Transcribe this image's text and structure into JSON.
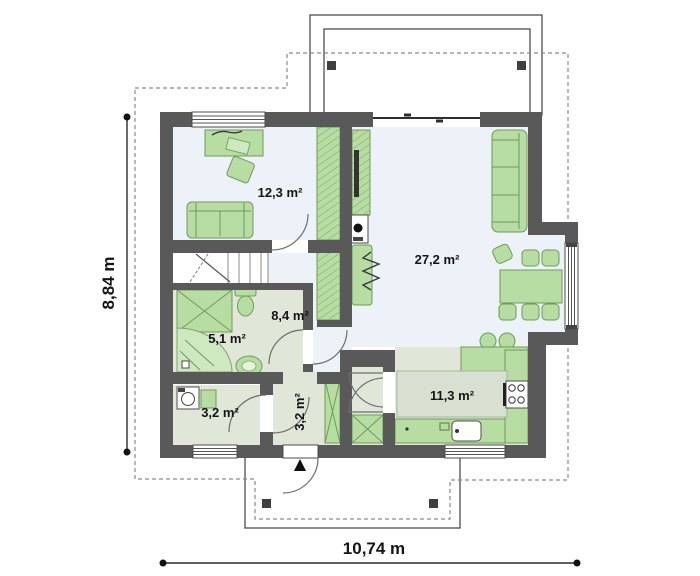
{
  "plan": {
    "type": "architectural-floor-plan",
    "rooms": [
      {
        "key": "bedroom",
        "area": "12,3 m²"
      },
      {
        "key": "living_room",
        "area": "27,2 m²"
      },
      {
        "key": "hall",
        "area": "8,4 m²"
      },
      {
        "key": "bathroom",
        "area": "5,1 m²"
      },
      {
        "key": "utility_room",
        "area": "3,2 m²"
      },
      {
        "key": "vestibule",
        "area": "3,2 m²"
      },
      {
        "key": "kitchen",
        "area": "11,3 m²"
      }
    ],
    "dimensions": {
      "overall_width": "10,74 m",
      "overall_height": "8,84 m"
    },
    "colors": {
      "wall": "#595959",
      "furniture_fill": "#b7dda3",
      "furniture_stroke": "#6d9c58",
      "floor_cool": "#edf1f8",
      "floor_warm": "#e0e7d9",
      "island": "#d8e0d2",
      "dashed_outline": "#8a8a8a"
    }
  }
}
